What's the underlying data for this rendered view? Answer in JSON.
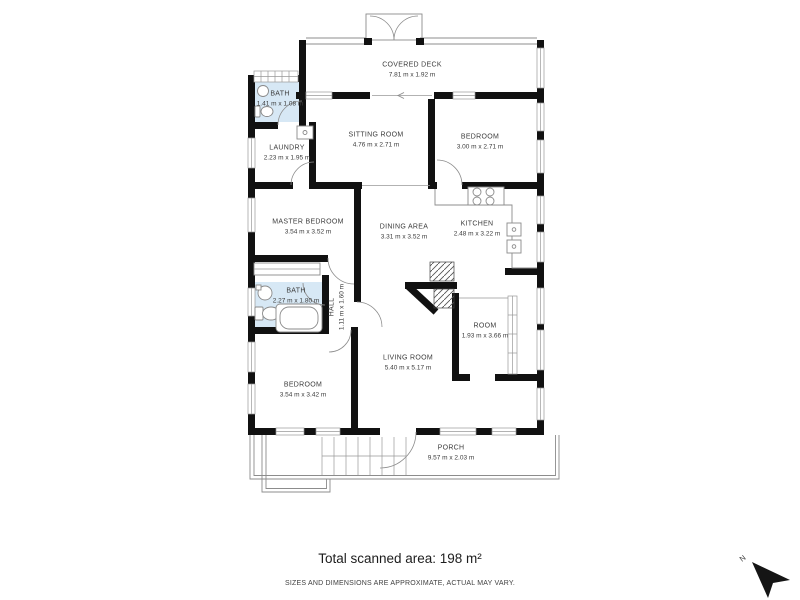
{
  "footer": {
    "total_area": "Total scanned area: 198 m²",
    "disclaimer": "SIZES AND DIMENSIONS ARE APPROXIMATE, ACTUAL MAY VARY."
  },
  "compass": {
    "north_label": "N"
  },
  "palette": {
    "wall": "#111111",
    "bath_fill": "#d7e8f5",
    "line_gray": "#8c8c8c",
    "text": "#3c3c3c"
  },
  "rooms": [
    {
      "id": "covered-deck",
      "name": "COVERED DECK",
      "dims": "7.81 m x 1.92 m"
    },
    {
      "id": "bath-top",
      "name": "BATH",
      "dims": "1.41 m x 1.08 m"
    },
    {
      "id": "laundry",
      "name": "LAUNDRY",
      "dims": "2.23 m x 1.95 m"
    },
    {
      "id": "sitting-room",
      "name": "SITTING ROOM",
      "dims": "4.76 m x 2.71 m"
    },
    {
      "id": "bedroom-top",
      "name": "BEDROOM",
      "dims": "3.00 m x 2.71 m"
    },
    {
      "id": "master-bedroom",
      "name": "MASTER BEDROOM",
      "dims": "3.54 m x 3.52 m"
    },
    {
      "id": "dining-area",
      "name": "DINING AREA",
      "dims": "3.31 m x 3.52 m"
    },
    {
      "id": "kitchen",
      "name": "KITCHEN",
      "dims": "2.48 m x 3.22 m"
    },
    {
      "id": "bath-mid",
      "name": "BATH",
      "dims": "2.27 m x 1.80 m"
    },
    {
      "id": "hall",
      "name": "HALL",
      "dims": "1.11 m x 1.60 m"
    },
    {
      "id": "room",
      "name": "ROOM",
      "dims": "1.93 m x 3.66 m"
    },
    {
      "id": "living-room",
      "name": "LIVING ROOM",
      "dims": "5.40 m x 5.17 m"
    },
    {
      "id": "bedroom-bottom",
      "name": "BEDROOM",
      "dims": "3.54 m x 3.42 m"
    },
    {
      "id": "porch",
      "name": "PORCH",
      "dims": "9.57 m x 2.03 m"
    }
  ]
}
